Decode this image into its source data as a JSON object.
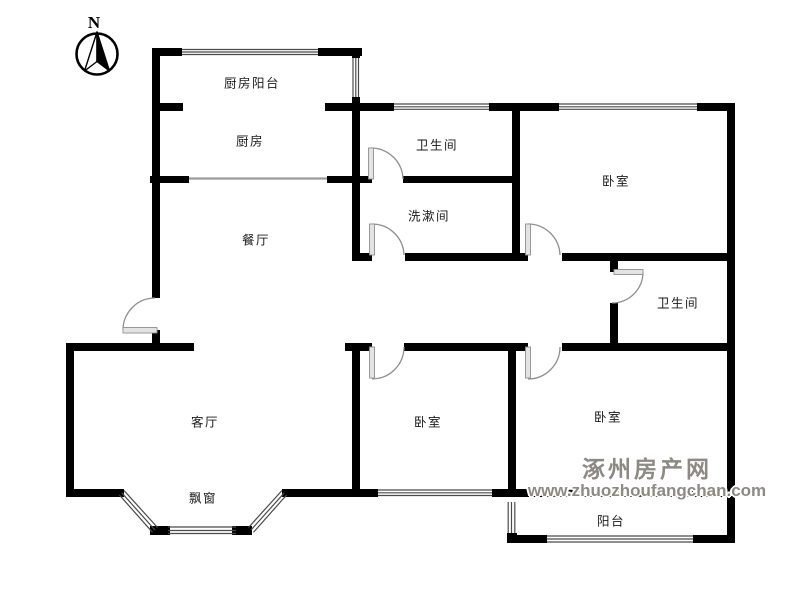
{
  "compass": {
    "label": "N",
    "icon": "compass-north-icon"
  },
  "rooms": {
    "kitchen_balcony": {
      "label": "厨房阳台"
    },
    "kitchen": {
      "label": "厨房"
    },
    "bathroom_top": {
      "label": "卫生间"
    },
    "washroom": {
      "label": "洗漱间"
    },
    "bedroom_top_right": {
      "label": "卧室"
    },
    "dining_room": {
      "label": "餐厅"
    },
    "bathroom_right": {
      "label": "卫生间"
    },
    "living_room": {
      "label": "客厅"
    },
    "bedroom_bottom_middle": {
      "label": "卧室"
    },
    "bedroom_bottom_right": {
      "label": "卧室"
    },
    "bay_window": {
      "label": "飘窗"
    },
    "balcony": {
      "label": "阳台"
    }
  },
  "watermark": {
    "site_name": "涿州房产网",
    "site_url": "www.zhuozhoufangchan.com",
    "color": "#8d8a84"
  },
  "colors": {
    "background": "#ffffff",
    "wall": "#000000",
    "window_line": "#4a4a4a",
    "door_line": "#8f8f8f",
    "door_leaf_fill": "#e3e3e3",
    "slider_line": "#9a9a9a"
  }
}
